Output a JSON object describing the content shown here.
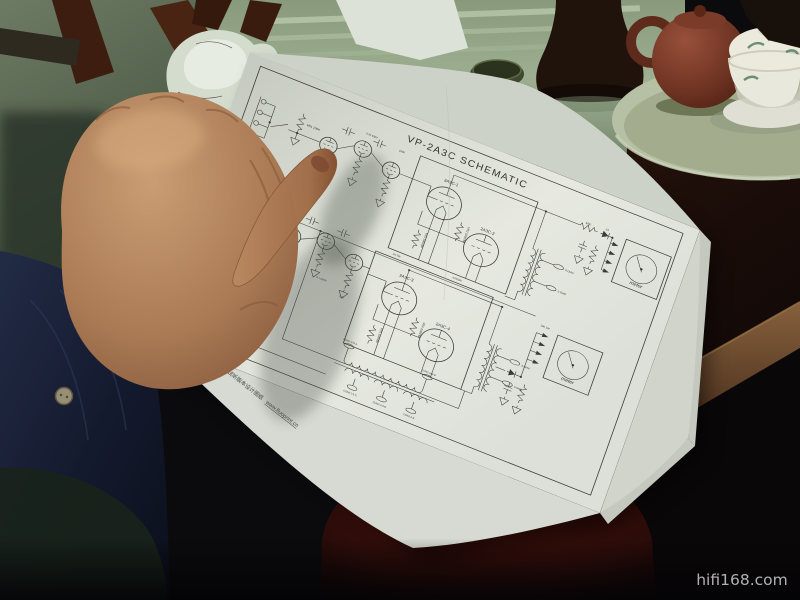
{
  "watermark": "hifi168.com",
  "schematic": {
    "title": "VP-2A3C SCHEMATIC",
    "footer_cn": "VP 系列产品 “DaWinco Pro” 试听版本设计图纸",
    "footer_url": "www.fluoprint.cn",
    "tube_labels": [
      "2A3C-1",
      "2A3C-2",
      "2A3C-3",
      "2A3C-4"
    ],
    "meter_label": "meter",
    "volume_pot": "VR1 100K",
    "hum_pots": [
      "VR2 100/2W",
      "VR3 100/2W",
      "VR4 100/2W",
      "VR5 100/2W"
    ],
    "load_resistor": "10K",
    "output_taps": [
      "8 OHM",
      "0 OHM"
    ],
    "connectors": [
      "CON2 370-A",
      "CON2 315-B",
      "CON2 2.5-C",
      "CON2 6.3-D",
      "CON2 0-E"
    ],
    "micro_labels": [
      "220K",
      "0.22 630V",
      "100K",
      "1K 2W",
      "10K 1W",
      "470K",
      "47/450V",
      "D1",
      "0.1 630V",
      "22K"
    ],
    "ink_color": "#3b3b35",
    "paper_color": "#e7e9e1"
  }
}
